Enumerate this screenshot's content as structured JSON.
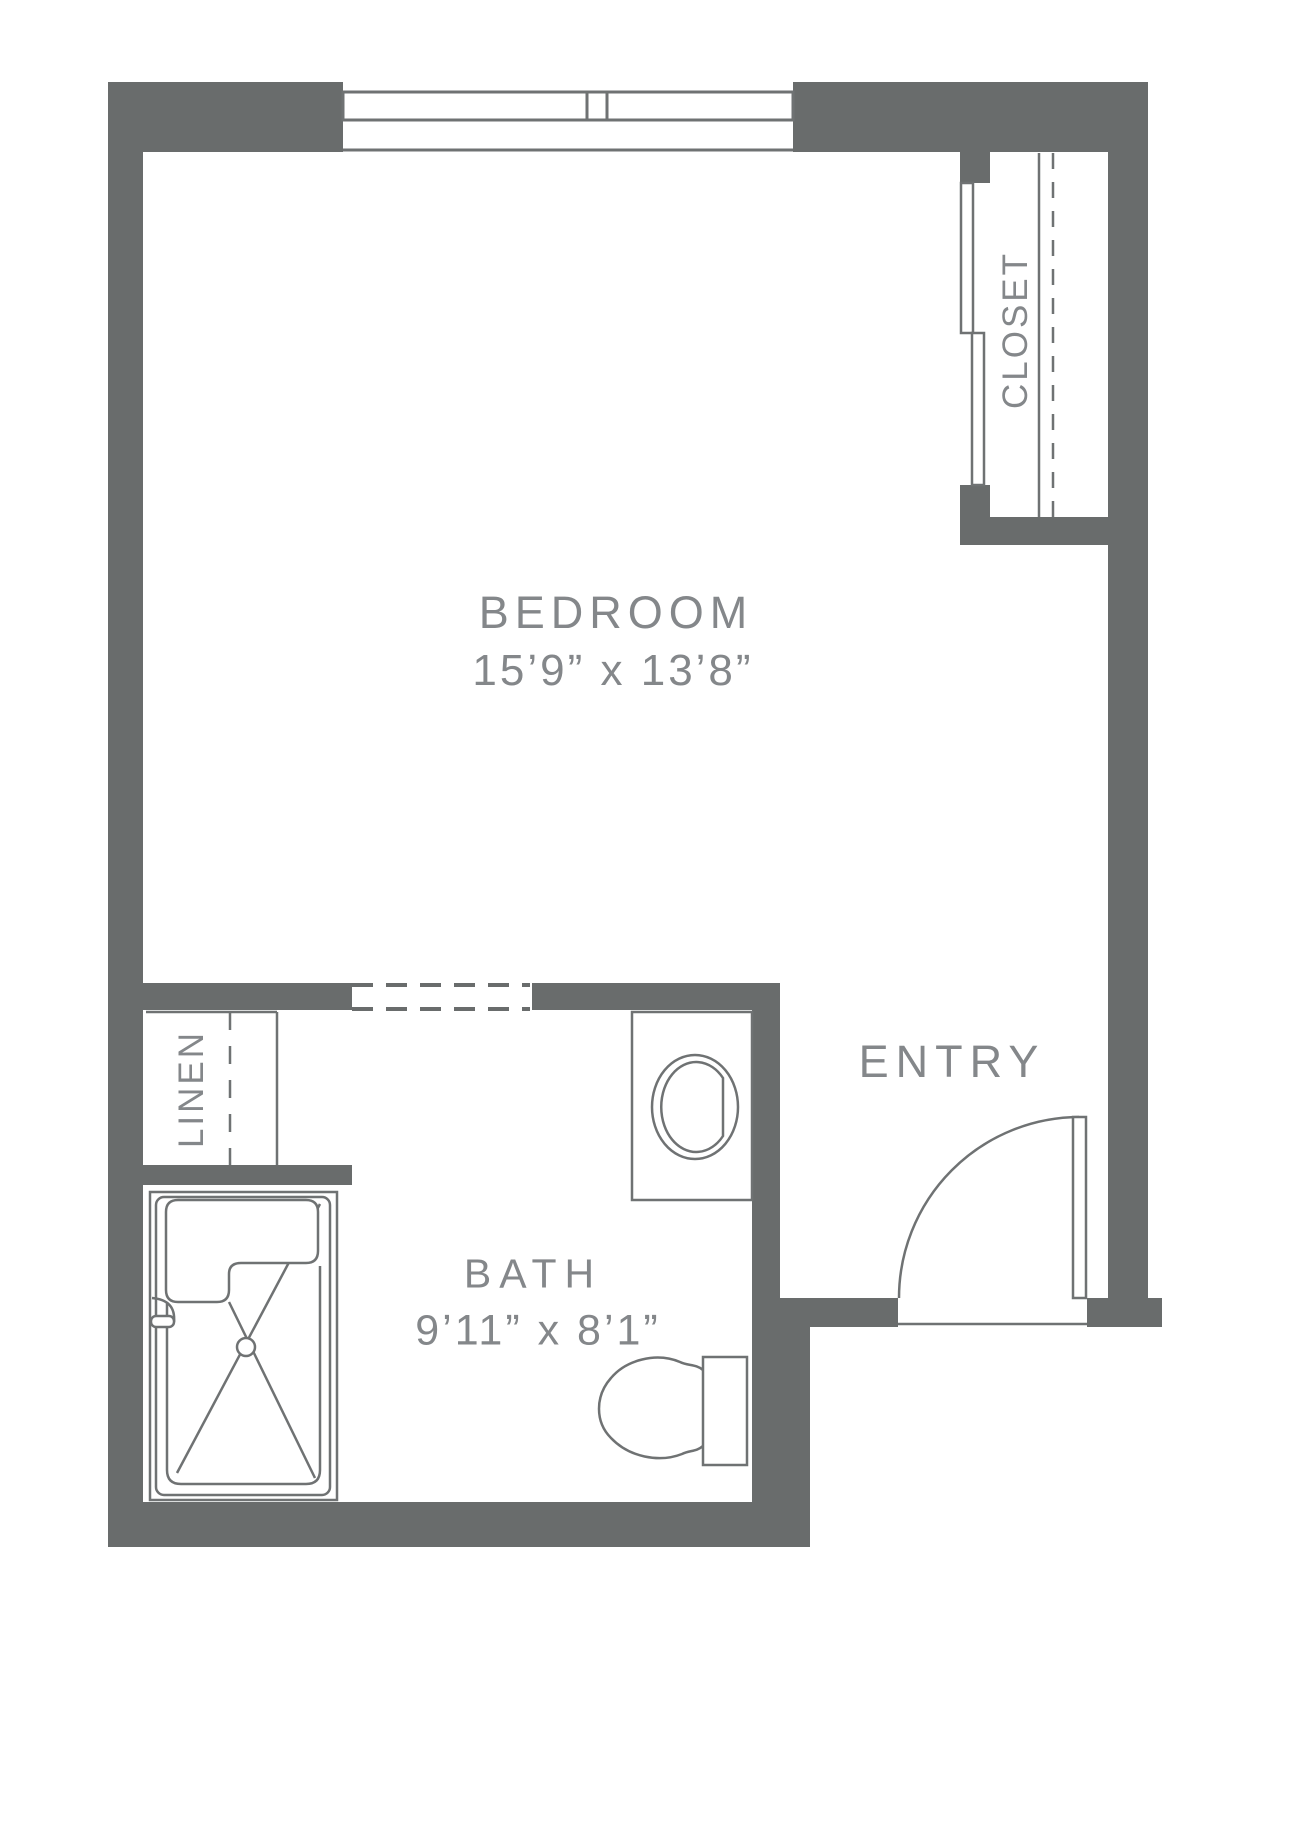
{
  "rooms": {
    "bedroom": {
      "label": "BEDROOM",
      "dimensions": "15’9” x 13’8”"
    },
    "bath": {
      "label": "BATH",
      "dimensions": "9’11” x 8’1”"
    },
    "entry": {
      "label": "ENTRY"
    },
    "closet": {
      "label": "CLOSET"
    },
    "linen": {
      "label": "LINEN"
    }
  },
  "fixtures": {
    "window": "double sliding window, top wall",
    "closet_doors": "bypass sliding doors",
    "closet_storage": "shelf (solid line) and rod (dashed line)",
    "linen_storage": "shelf (solid line) and rod (dashed line)",
    "bath_fixtures": "vanity with oval sink, toilet, shower stall with drain",
    "entry_door": "90-degree in-swing entry door"
  },
  "colors": {
    "wall": "#696c6c",
    "fixture_line": "#6f7273",
    "label_text": "#84878a",
    "background": "#ffffff"
  }
}
